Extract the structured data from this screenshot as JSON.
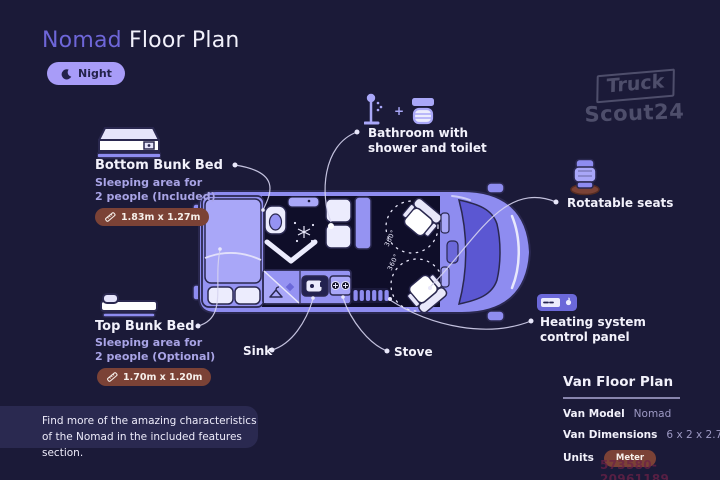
{
  "window": {
    "width": 720,
    "height": 480
  },
  "header": {
    "title_accent": "Nomad",
    "title_rest": " Floor Plan",
    "mode_badge": {
      "icon": "moon-icon",
      "label": "Night"
    }
  },
  "brand_watermark": {
    "line1": "Truck",
    "line2": "Scout24"
  },
  "features": {
    "bottom_bunk": {
      "icon": "bunk-bed-icon",
      "title": "Bottom Bunk Bed",
      "desc_line1": "Sleeping area for",
      "desc_line2": "2 people (Included)",
      "dimensions": "1.83m x 1.27m"
    },
    "top_bunk": {
      "icon": "bunk-bed-icon",
      "title": "Top Bunk Bed",
      "desc_line1": "Sleeping area for",
      "desc_line2": "2 people (Optional)",
      "dimensions": "1.70m x 1.20m"
    },
    "bathroom": {
      "icons": [
        "shower-icon",
        "plus",
        "toilet-icon"
      ],
      "plus_sign": "+",
      "label_line1": "Bathroom with",
      "label_line2": "shower and toilet"
    },
    "rotatable_seats": {
      "icon": "seat-icon",
      "label": "Rotatable seats"
    },
    "heating": {
      "icon": "heating-panel-icon",
      "label_line1": "Heating system",
      "label_line2": "control panel"
    },
    "sink": {
      "label": "Sink"
    },
    "stove": {
      "label": "Stove"
    }
  },
  "floorplan": {
    "rotation_label_front": "360°",
    "rotation_label_rear": "360°"
  },
  "note": {
    "line1": "Find more of the amazing characteristics",
    "line2": "of the Nomad in the included features section."
  },
  "spec_panel": {
    "title": "Van Floor Plan",
    "model_label": "Van Model",
    "model_value": "Nomad",
    "dimensions_label": "Van Dimensions",
    "dimensions_value": "6 x 2 x 2.75 m",
    "units_label": "Units",
    "units_value": "Meter"
  },
  "listing_id": "573580-20961189",
  "colors": {
    "background": "#1B1A38",
    "accent_purple": "#6E66D8",
    "van_body": "#8E8CF0",
    "van_interior_dark": "#0F0E29",
    "lavender_icon": "#A9A7F8",
    "badge_rust": "#7B4236",
    "night_pill": "#A89CF8",
    "text_light": "#F2F1FB",
    "muted_value": "#9D99C4"
  }
}
